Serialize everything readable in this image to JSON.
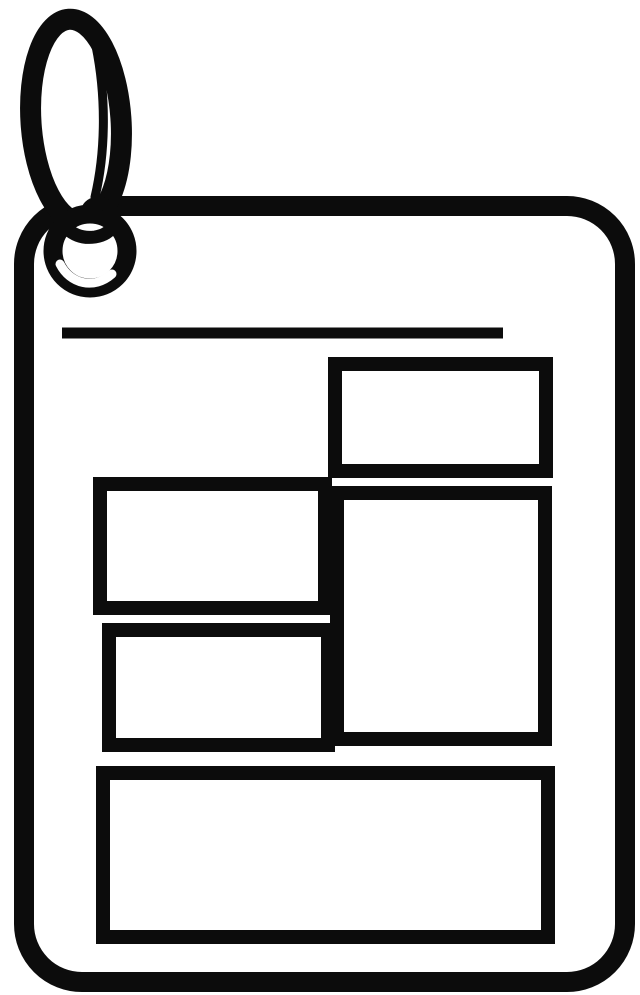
{
  "icon": {
    "name": "keyring-tag-with-page-layout-icon",
    "style": "black-and-white line art clipart",
    "colors": {
      "ink": "#0c0c0c",
      "paper": "#ffffff"
    },
    "elements": {
      "keyring": "key-ring-icon looped through the top-left of the tag",
      "tag": "rounded-rectangle tag body with thick outline",
      "headline_rule": "single horizontal line near the top of the tag",
      "content_blocks": [
        "top-right-block",
        "left-upper-block",
        "right-tall-block",
        "left-lower-block",
        "bottom-wide-block"
      ],
      "block_count": 5,
      "blocks_contain_text": false
    }
  }
}
